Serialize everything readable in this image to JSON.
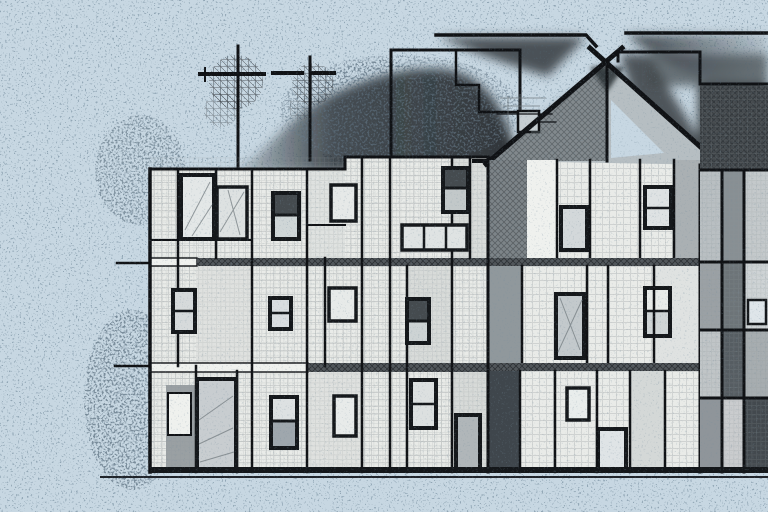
{
  "meta": {
    "title": "Stylized pen-and-ink illustration of a modular row-house building",
    "style": "black ink line drawing with airbrush smoke and speckle on a pale blue background",
    "canvas": {
      "width_px": 768,
      "height_px": 512
    }
  },
  "colors": {
    "sky": "#c7d7e2",
    "ink": "#101215",
    "facade_light": "#e9ebe8",
    "facade_bright": "#eff1ee",
    "facade_mid": "#c9cecf",
    "facade_shaded": "#9aa0a3",
    "panel_charcoal": "#3f464c",
    "right_block_top": "#373d41",
    "gable_shade": "#767c80",
    "smoke": "#272c30",
    "window_frame": "#15181b",
    "pane_light": "#dfe3e4",
    "pane_dark": "#454b4f",
    "ground": "#14171a",
    "speckle": "#2e4456"
  },
  "scene": {
    "background": "pale blue sky covered with fine dark speckle grain, denser near the building silhouette",
    "smoke_plume": "large soft charcoal smoke mound rising behind the left roof toward the gable, with dark trails under the upper horizontal beams",
    "antennas": {
      "count": 2,
      "description": "two tall T-shaped rooftop antennas with scribbled mesh blobs at their crossbars"
    },
    "buildings": {
      "left_block": "flat-roofed three-storey block with gridded off-white facade, hatched floor divider bands, thin balcony ledges protruding left, many dark-framed windows and two tall doors",
      "center_house": "gabled house, roof drawn as thick crossing strokes over the apex, shaded left gable half, small square vent on the gable, Mondrian-like panelled facade below",
      "right_block": "partially cropped block at the right edge with a dark smoked top band and vertical panels in mixed grays"
    },
    "top_structures": "outlined rectangular superstructure behind the left roof and long horizontal beam lines running to the right edge",
    "ground": "single thin ground line with a heavy dark base strip under the whole building",
    "floors": 3
  }
}
